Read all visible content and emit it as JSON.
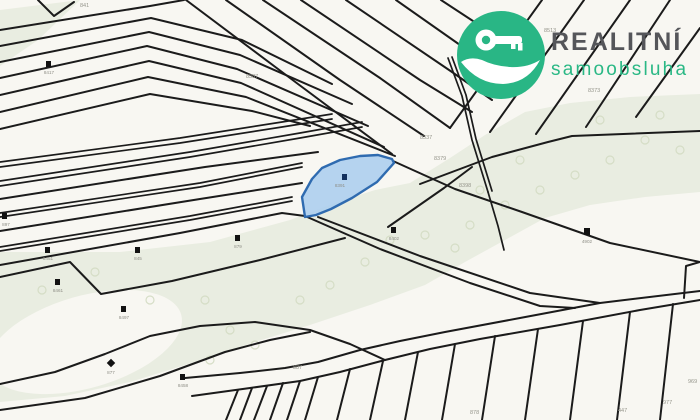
{
  "logo": {
    "brand": "REALITNÍ",
    "subtitle": "samoobsluha",
    "icon": "key-in-hand-icon",
    "brand_color": "#29b685",
    "brand_text_color": "#55565a"
  },
  "map": {
    "type": "cadastral-map",
    "colors": {
      "background": "#f8f7f2",
      "field_green": "#e9ede1",
      "boundary_line": "#1b1b1b",
      "highlight_fill": "#a9cdee",
      "highlight_stroke": "#2f6bb0"
    },
    "highlight_parcel": {
      "number": "8391"
    },
    "parcel_labels": [
      {
        "text": "841"
      },
      {
        "text": "8387"
      },
      {
        "text": "8513"
      },
      {
        "text": "8373"
      },
      {
        "text": "8337"
      },
      {
        "text": "8379"
      },
      {
        "text": "8398"
      },
      {
        "text": "887"
      },
      {
        "text": "878"
      },
      {
        "text": "447"
      },
      {
        "text": "977"
      },
      {
        "text": "969"
      }
    ],
    "point_markers": [
      {
        "label": "8417"
      },
      {
        "label": "897"
      },
      {
        "label": "8451"
      },
      {
        "label": "845"
      },
      {
        "label": "879"
      },
      {
        "label": "8461"
      },
      {
        "label": "8497"
      },
      {
        "label": "877"
      },
      {
        "label": "8458"
      },
      {
        "label": "8402"
      },
      {
        "label": "4902"
      },
      {
        "label": "8391"
      }
    ]
  }
}
